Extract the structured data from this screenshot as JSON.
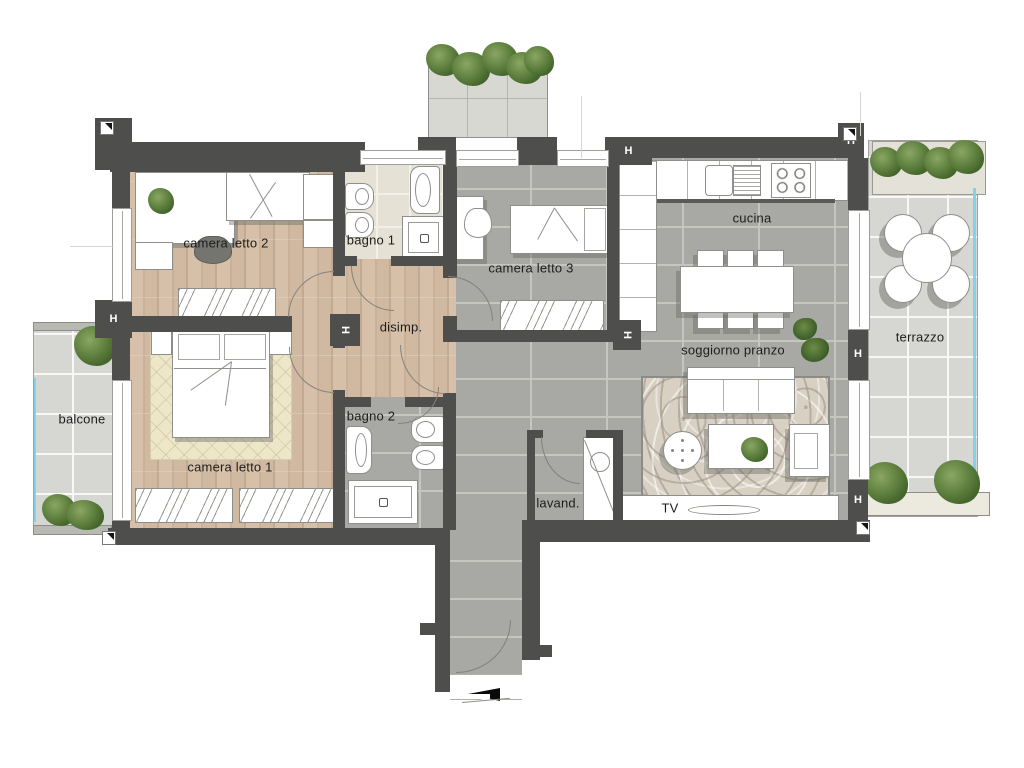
{
  "plan": {
    "title": "apartment floor plan",
    "column_marker": "H",
    "rooms": [
      {
        "id": "camera-letto-2",
        "label": "camera letto 2"
      },
      {
        "id": "bagno-1",
        "label": "bagno 1"
      },
      {
        "id": "camera-letto-3",
        "label": "camera letto 3"
      },
      {
        "id": "cucina",
        "label": "cucina"
      },
      {
        "id": "disimpegno",
        "label": "disimp."
      },
      {
        "id": "camera-letto-1",
        "label": "camera letto 1"
      },
      {
        "id": "bagno-2",
        "label": "bagno 2"
      },
      {
        "id": "soggiorno-pranzo",
        "label": "soggiorno pranzo"
      },
      {
        "id": "lavanderia",
        "label": "lavand."
      },
      {
        "id": "balcone",
        "label": "balcone"
      },
      {
        "id": "terrazzo",
        "label": "terrazzo"
      },
      {
        "id": "tv",
        "label": "TV"
      }
    ],
    "colors": {
      "wall": "#4e4f4d",
      "wood_floor": "#d2bba3",
      "tile_gray": "#a8a9a4",
      "tile_beige": "#e6e1d5",
      "tile_light": "#d6d7d2",
      "glass_railing": "#7fd4e8",
      "plant": "#4e7134",
      "furniture": "#ffffff"
    }
  }
}
